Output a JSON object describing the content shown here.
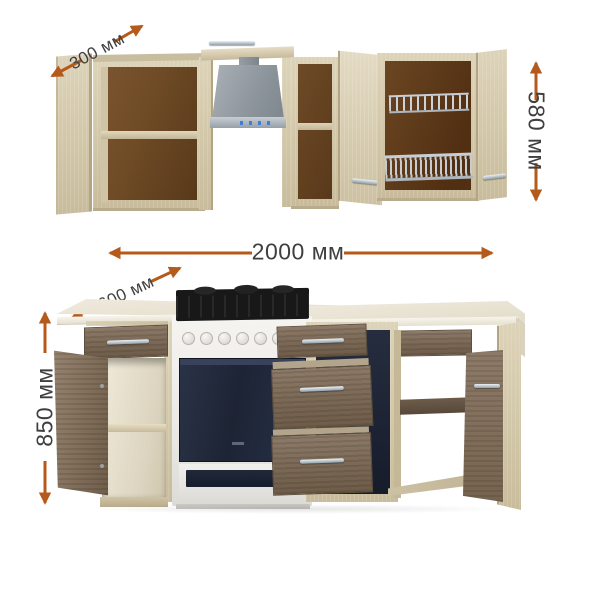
{
  "diagram": {
    "type": "kitchen-set-dimensions",
    "units": "мм",
    "dims": {
      "wall_depth": "300 мм",
      "wall_height": "580 мм",
      "total_width": "2000 мм",
      "base_depth": "600 мм",
      "base_height": "850 мм"
    },
    "colors": {
      "background": "#ffffff",
      "arrow": "#b55a1b",
      "dim_text": "#3f3f3f",
      "wood_light": "#d5caae",
      "wood_dark": "#81705f",
      "interior_back": "#6e4a25",
      "countertop": "#ede8da",
      "hood_gray": "#9aa1a8",
      "oven_navy": "#1f2638",
      "stove_white": "#f3f2ef",
      "chrome": "#c6cdd3"
    }
  }
}
